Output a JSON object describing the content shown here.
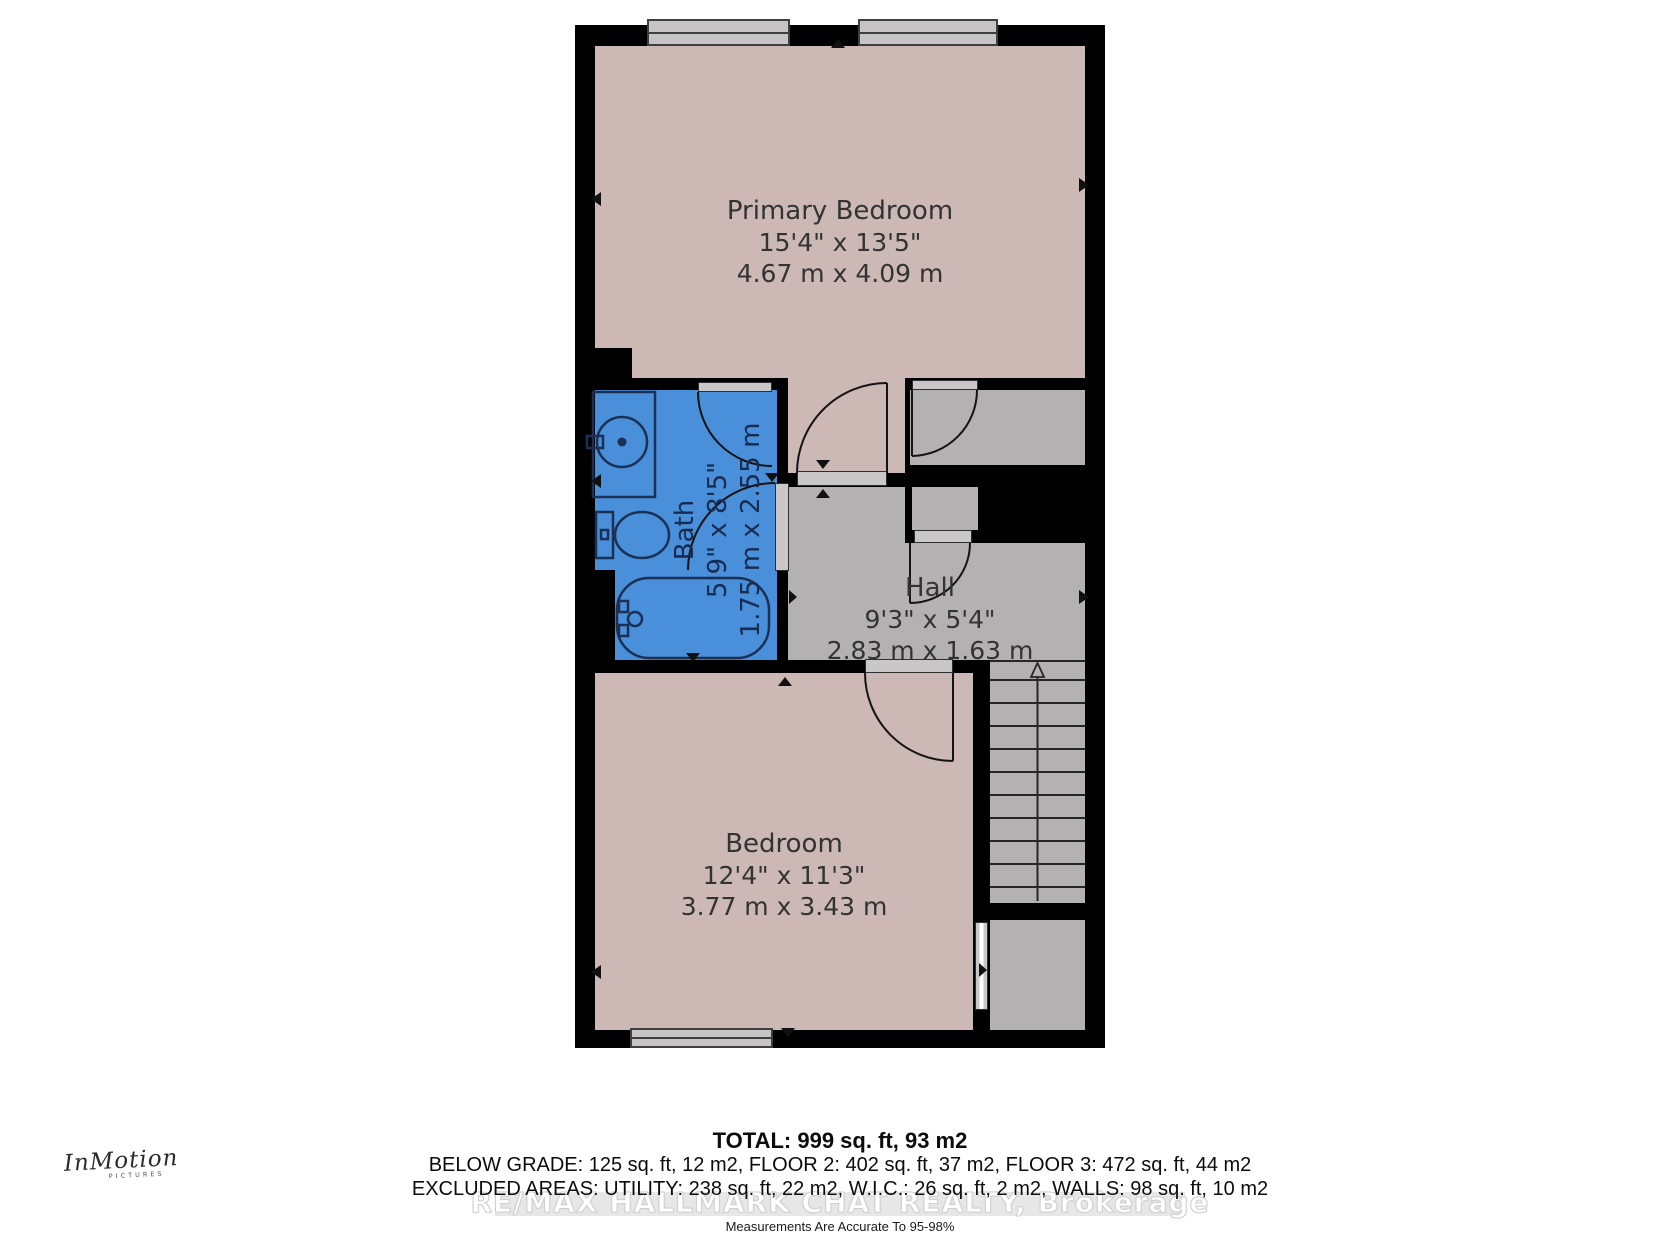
{
  "plan": {
    "rooms": {
      "primary_bedroom": {
        "name": "Primary Bedroom",
        "dims_imperial": "15'4\" x 13'5\"",
        "dims_metric": "4.67 m x 4.09 m"
      },
      "bath": {
        "name": "Bath",
        "dims_imperial": "5'9\" x 8'5\"",
        "dims_metric": "1.75 m x 2.55 m"
      },
      "hall": {
        "name": "Hall",
        "dims_imperial": "9'3\" x 5'4\"",
        "dims_metric": "2.83 m x 1.63 m"
      },
      "bedroom": {
        "name": "Bedroom",
        "dims_imperial": "12'4\" x 11'3\"",
        "dims_metric": "3.77 m x 3.43 m"
      }
    },
    "features": [
      "stairs-up",
      "closet",
      "alcove",
      "storage"
    ]
  },
  "summary": {
    "total": "TOTAL: 999 sq. ft, 93 m2",
    "floors": "BELOW GRADE: 125 sq. ft, 12 m2, FLOOR 2: 402 sq. ft, 37 m2, FLOOR 3: 472 sq. ft, 44 m2",
    "excluded": "EXCLUDED AREAS: UTILITY: 238 sq. ft, 22 m2, W.I.C.: 26 sq. ft, 2 m2, WALLS: 98 sq. ft, 10 m2",
    "accuracy": "Measurements Are Accurate To 95-98%"
  },
  "watermark": "RE/MAX HALLMARK CHAT REALTY, Brokerage",
  "logo": {
    "name": "InMotion",
    "subtitle": "PICTURES"
  },
  "colors": {
    "room_pink": "#ccb8b5",
    "room_gray": "#b3b1b1",
    "bath_blue": "#4a8fd9",
    "wall_black": "#000000",
    "door_sill": "#c9c7c7",
    "window_gray": "#c6c4c4",
    "fixture_outline": "#1c3055",
    "watermark_gray": "#e8e7e7"
  }
}
